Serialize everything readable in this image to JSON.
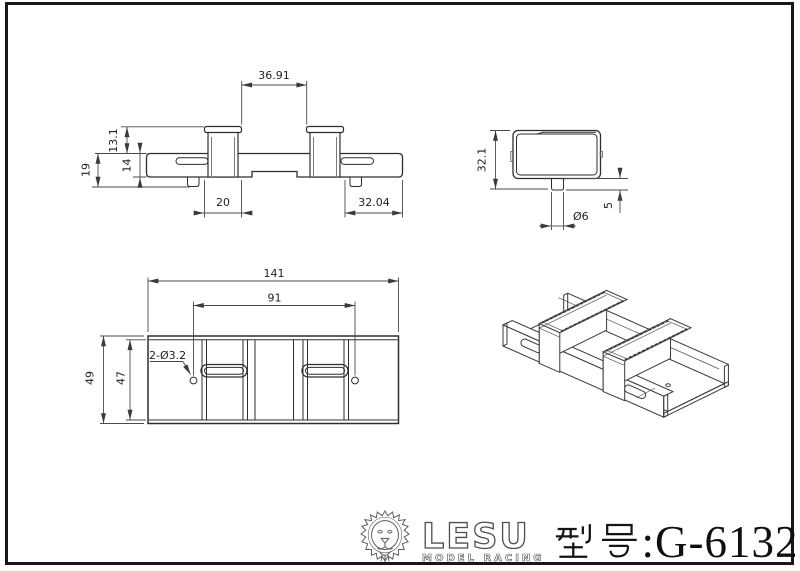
{
  "page": {
    "background": "#ffffff",
    "border_color": "#181818"
  },
  "drawing": {
    "front_view": {
      "dim_top_span": "36.91",
      "dim_block_height": "13.1",
      "dim_rail_height": "14",
      "dim_total_height": "19",
      "dim_block_width": "20",
      "dim_right_span": "32.04"
    },
    "side_view": {
      "dim_height": "32.1",
      "dim_tab_diameter": "Ø6",
      "dim_tab_length": "5"
    },
    "top_view": {
      "dim_total_length": "141",
      "dim_hole_span": "91",
      "dim_holes": "2-Ø3.2",
      "dim_outer_width": "49",
      "dim_inner_width": "47"
    }
  },
  "title_block": {
    "brand": "LESU",
    "brand_subtitle": "MODEL RACING",
    "model_prefix": "型号",
    "model_number": ":G-6132",
    "lion_icon": "lion-head-logo",
    "text_color": "#101010"
  }
}
